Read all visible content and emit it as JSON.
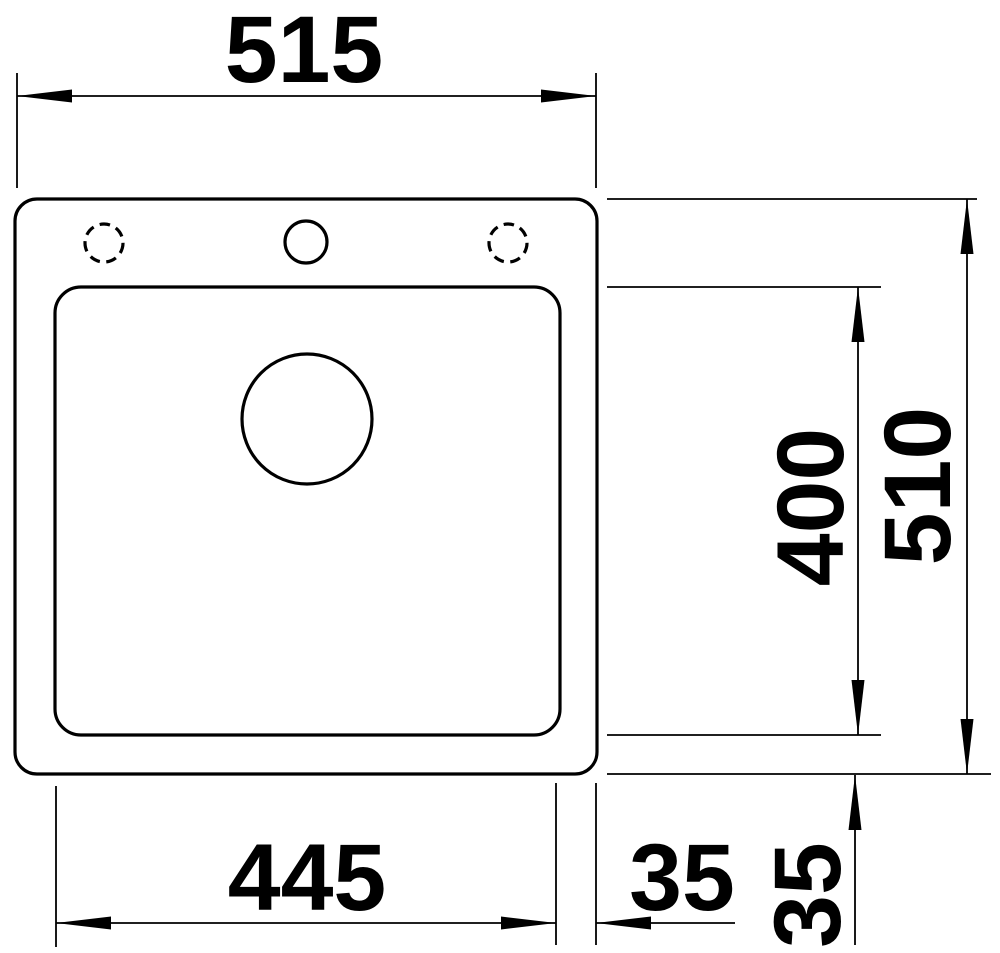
{
  "drawing": {
    "colors": {
      "line": "#000000",
      "background": "#ffffff"
    },
    "dimensions": {
      "overall_width": "515",
      "overall_depth": "510",
      "bowl_depth": "400",
      "bowl_width": "445",
      "gap_right": "35",
      "gap_bottom": "35"
    }
  }
}
